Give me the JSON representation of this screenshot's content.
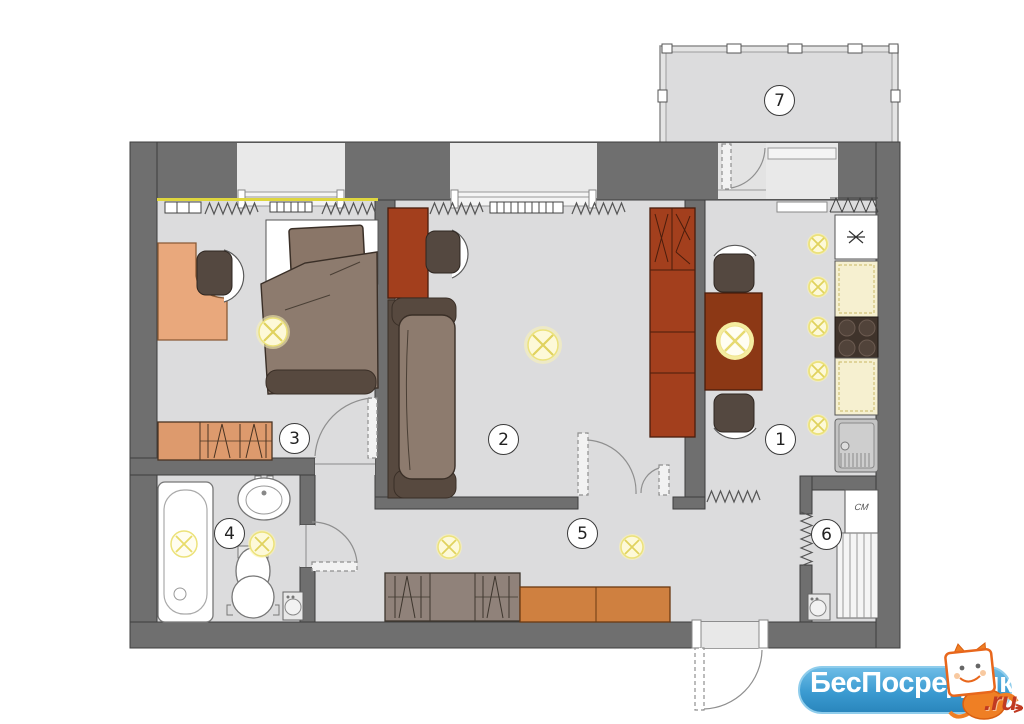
{
  "rooms": [
    {
      "number": "1"
    },
    {
      "number": "2"
    },
    {
      "number": "3"
    },
    {
      "number": "4"
    },
    {
      "number": "5"
    },
    {
      "number": "6"
    },
    {
      "number": "7"
    }
  ],
  "labels": {
    "washing_machine": "СМ"
  },
  "watermark": {
    "brand": "БесПосредника",
    "tld": ".ru"
  },
  "colors": {
    "wall": "#6f6f6f",
    "floor": "#dcdcdd",
    "accent_wood_light": "#e9a87c",
    "accent_wood_orange": "#cf8040",
    "furniture_red": "#a33f1d",
    "sofa_brown": "#8d7b6e",
    "dark_brown": "#57493f",
    "light_yellow": "#fdf9d8",
    "counter_cream": "#f6f0d0",
    "banner_blue": "#3b9bd1",
    "tld_red": "#c03a22"
  }
}
